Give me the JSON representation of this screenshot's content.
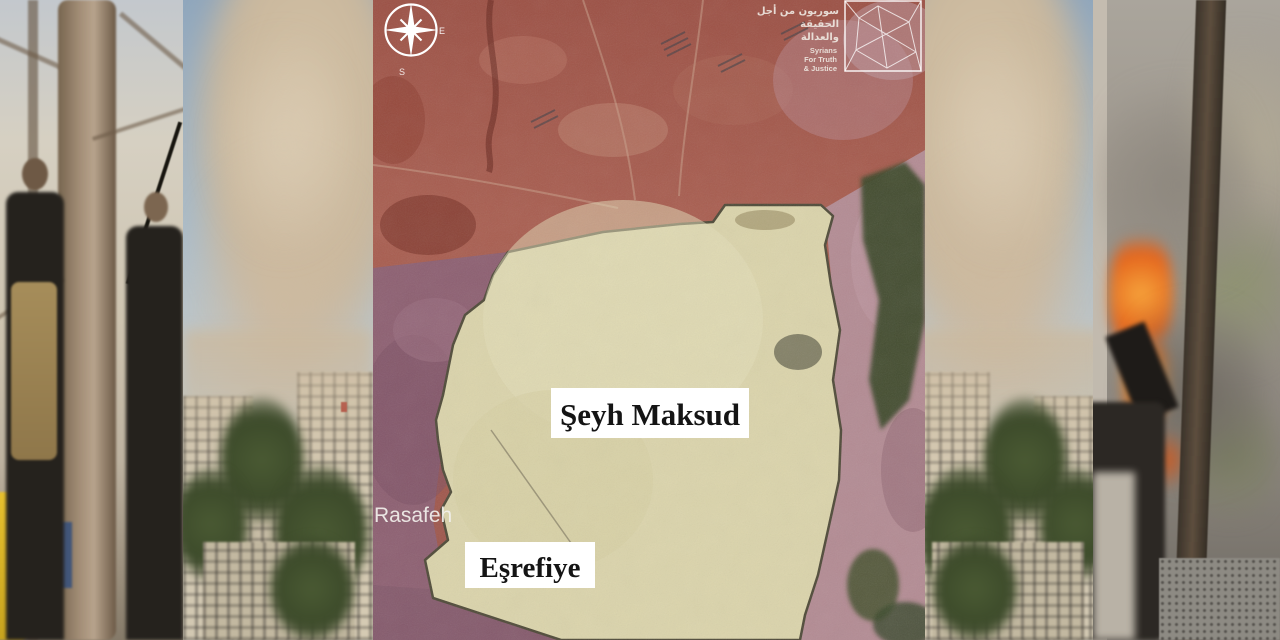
{
  "collage": {
    "panels": [
      {
        "id": "fighters",
        "description": "Two armed fighters in tactical vests standing among bare trees, yellow taxi behind"
      },
      {
        "id": "dust-cloud-left",
        "description": "Tan dust cloud rising over beige buildings and green trees under blue sky"
      },
      {
        "id": "satellite-map",
        "description": "Annotated satellite map of Aleppo neighborhoods"
      },
      {
        "id": "dust-cloud-right",
        "description": "Mirrored dust cloud rising over buildings and trees"
      },
      {
        "id": "burning-vehicle",
        "description": "Burning vehicle with orange flames and smoke beside a tree trunk, debris on ground"
      }
    ]
  },
  "map": {
    "neighborhood_labels": {
      "sheikh_maqsood": "Şeyh Maksud",
      "ashrafieh": "Eşrefiye",
      "rasafeh": "Rasafeh"
    },
    "compass": {
      "east": "E",
      "south": "S"
    },
    "logo": {
      "arabic_line1": "سوريون من أجل",
      "arabic_line2": "الحقيقة",
      "arabic_line3": "والعدالة",
      "english_line1": "Syrians",
      "english_line2": "For Truth",
      "english_line3": "& Justice"
    },
    "colors": {
      "highlight_fill": "#dbd4ab",
      "highlight_border": "#4f4a38",
      "terrain_red": "#a2564a",
      "urban_purple": "#8d5f71",
      "urban_pink": "#b38b93",
      "vegetation_green": "#3a4829",
      "label_background": "#ffffff",
      "label_text": "#141414"
    }
  }
}
